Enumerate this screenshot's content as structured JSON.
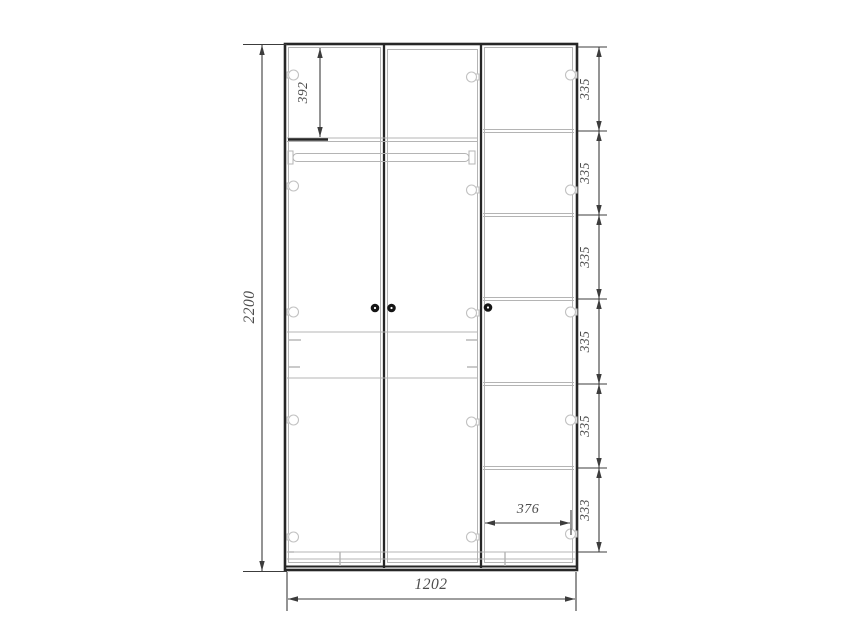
{
  "colors": {
    "c-bg": "#ffffff",
    "c-outline": "#262626",
    "c-thin": "#b4b4b4",
    "c-dim": "#3c3c3c",
    "c-text": "#4c4c4c"
  },
  "dimensions": {
    "overall_height_mm": "2200",
    "overall_width_mm": "1202",
    "top_compartment_mm": "392",
    "right_compartment_width_mm": "376",
    "right_shelf_chain_mm": [
      "335",
      "335",
      "335",
      "335",
      "335",
      "333"
    ]
  }
}
